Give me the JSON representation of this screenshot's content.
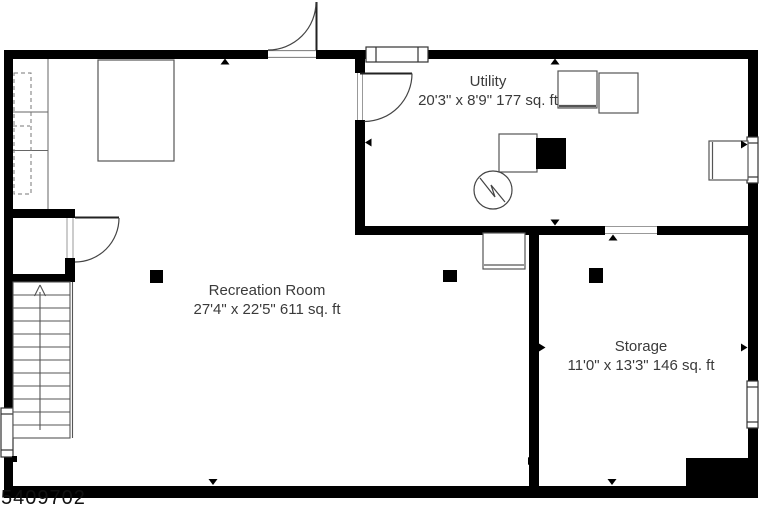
{
  "floor_plan": {
    "mls_number": "5409702",
    "rooms": [
      {
        "name": "Utility",
        "dimensions": "20'3\" x 8'9\" 177 sq. ft"
      },
      {
        "name": "Recreation Room",
        "dimensions": "27'4\" x 22'5\" 611 sq. ft"
      },
      {
        "name": "Storage",
        "dimensions": "11'0\" x 13'3\" 146 sq. ft"
      }
    ],
    "symbols": [
      "staircase-up-arrow",
      "closet-shelving",
      "door-swing",
      "window",
      "bed",
      "washer",
      "dryer",
      "furnace",
      "pump",
      "sink-cabinet",
      "support-column"
    ],
    "colors": {
      "wall": "#000000",
      "label_text": "#3a3a3a",
      "background": "#ffffff",
      "furniture_line": "#555555"
    }
  }
}
